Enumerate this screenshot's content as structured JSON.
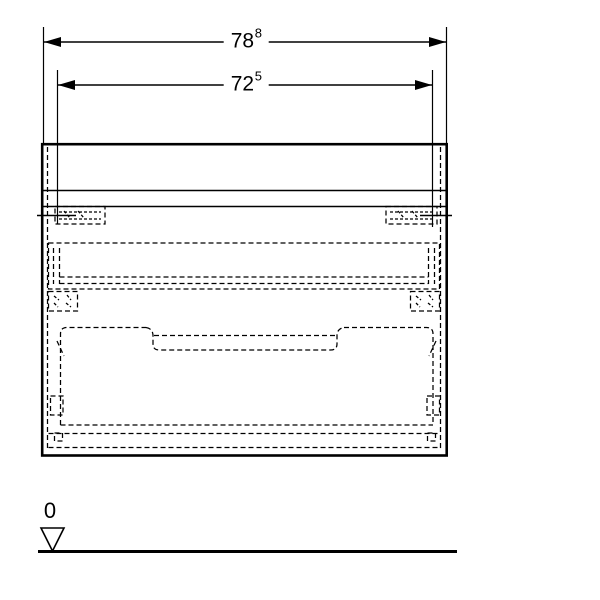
{
  "drawing": {
    "type": "furniture-dimension-drawing",
    "dimensions": {
      "outer_width": {
        "value": "78",
        "superscript": "8"
      },
      "inner_width": {
        "value": "72",
        "superscript": "5"
      }
    },
    "datum": {
      "label": "0"
    },
    "colors": {
      "line": "#000000",
      "background": "#ffffff"
    }
  }
}
